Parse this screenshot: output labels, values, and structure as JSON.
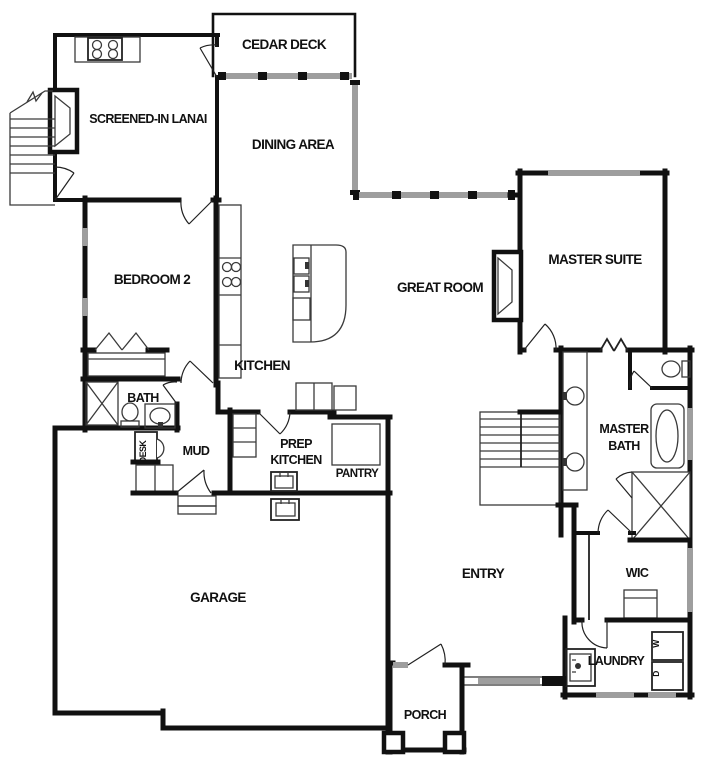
{
  "plan": {
    "rooms": {
      "cedar_deck": "CEDAR DECK",
      "screened_in_lanai": "SCREENED-IN LANAI",
      "dining_area": "DINING AREA",
      "bedroom_2": "BEDROOM 2",
      "kitchen": "KITCHEN",
      "great_room": "GREAT ROOM",
      "master_suite": "MASTER SUITE",
      "bath": "BATH",
      "desk": "DESK",
      "mud": "MUD",
      "prep_kitchen_line1": "PREP",
      "prep_kitchen_line2": "KITCHEN",
      "pantry": "PANTRY",
      "master_bath_line1": "MASTER",
      "master_bath_line2": "BATH",
      "garage": "GARAGE",
      "entry": "ENTRY",
      "wic": "WIC",
      "laundry": "LAUNDRY",
      "porch": "PORCH"
    },
    "appliances": {
      "washer": "W",
      "dryer": "D"
    },
    "colors": {
      "wall": "#111111",
      "window": "#9e9e9e",
      "line": "#3a3a3a",
      "background": "#ffffff"
    }
  }
}
